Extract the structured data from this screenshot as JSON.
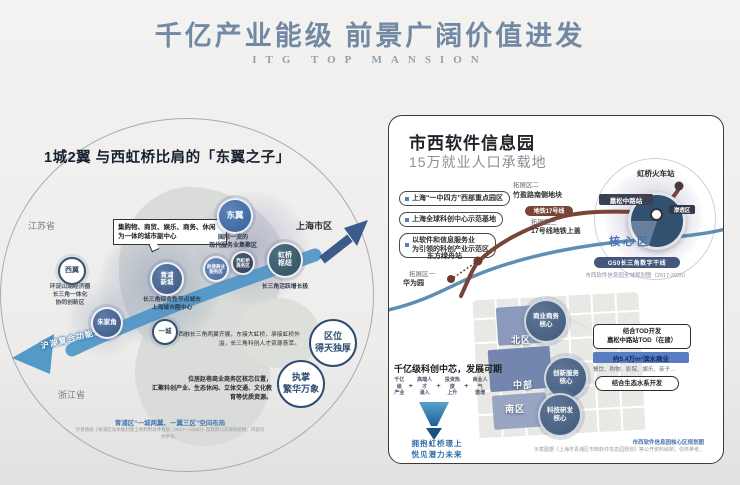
{
  "header": {
    "title": "千亿产业能级  前景广阔价值进发",
    "subtitle": "ITG TOP MANSION"
  },
  "left_panel": {
    "title": "1城2翼 与西虹桥比肩的「东翼之子」",
    "labels": {
      "jiangsu": "江苏省",
      "zhejiang": "浙江省",
      "shanghai": "上海市区"
    },
    "callout": "集购物、商贸、娱乐、商务、休闲\n为一体的城市副中心",
    "axis": "沪湖复合功能发展轴",
    "nodes": {
      "dongyi": "东翼",
      "dongyi_sub": "国际一流的\n现代服务业集聚区",
      "xiyi": "西翼",
      "xiyi_sub": "环淀山湖经济圈\n长三角一体化\n协同创新区",
      "qingpu": "青浦\n新城",
      "qingpu_sub": "长三角综合性节点城市\n上海城市圈中心",
      "zhujiajiao": "朱家角",
      "hongqiao": "虹桥\n枢纽",
      "hongqiao_sub": "长三角活跃增长极",
      "yicheng": "一城",
      "zhaoxiang": "赵巷商业\n服务区",
      "xihongqiao": "西虹桥\n商务区"
    },
    "para_east": "西融长三角两翼齐展，东接大虹桥，承接虹桥外溢，长三角科创人才资源荟萃。",
    "para_location": "位居赵巷商业商务区核芯位置，\n汇聚科创产业、生态休闲、立体交通、文化教育等优质资源。",
    "badge_location": "区位\n得天独厚",
    "badge_prosperity": "执掌\n繁华万象",
    "caption": "青浦区“一城两翼、一翼三区”空间布局",
    "footnote": "示意图据《青浦区总体规划暨土地利用总体规划（2017—2035）》及政府公开资料绘制，内容仅供参考。"
  },
  "right_panel": {
    "title": "市西软件信息园",
    "subtitle": "15万就业人口承载地",
    "pills": [
      "上海“一中四方”西部重点园区",
      "上海全球科创中心示范基地",
      "以软件和信息服务业\n为引领的科创产业示范区"
    ],
    "map": {
      "hongqiao_station": "虹桥火车站",
      "jiasong_station": "嘉松中路站",
      "line17": "地铁17号线",
      "zone_penetration": "渗透区",
      "zone_core": "核心区",
      "ext2": "拓展区二",
      "ext2_sub": "竹盈路南侧地块",
      "ext3": "拓展区三",
      "ext3_sub": "17号线地铁上盖",
      "dongfang_station": "东方绿舟站",
      "ext1": "拓展区一",
      "ext1_sub": "华为园",
      "g50": "G50长三角数字干线",
      "g50_caption": "市西软件信息园全域规划图（2017-2025）",
      "zone_north": "北区",
      "zone_mid": "中部",
      "zone_south": "南区",
      "core_business": "商业商务\n核心",
      "core_innovation": "创新服务\n核心",
      "core_tech": "科技研发\n核心"
    },
    "callouts": {
      "tod_line1": "结合TOD开发",
      "tod_line2": "嘉松中路站TOD（在建）",
      "waterfront": "约5.4万m²滨水商业",
      "waterfront_sub": "餐饮、购物、影院、娱乐、亲子…",
      "eco": "结合生态水系开发"
    },
    "bottom": {
      "headline": "千亿级科创中芯，发展可期",
      "items": [
        "千亿级\n产业",
        "高端人才\n涌入",
        "投资热度\n上升",
        "商业人气\n激增"
      ],
      "plus": "+",
      "slogan": "拥抱虹桥璟上\n悦见潜力未来"
    },
    "caption": "市西软件信息园核心区规划图",
    "footnote": "示意图据《上海市青浦区市西软件信息园规划》等公开资料绘制，仅供参考。"
  },
  "colors": {
    "header_text": "#7289a3",
    "axis_arrow": "#4d95c7",
    "node_fill": "#4a6494",
    "metro_line17": "#7a4337",
    "river_blue": "#4f81aa",
    "highlight_bar": "#5a7cc2",
    "core_zone_label": "#4a72b0"
  }
}
